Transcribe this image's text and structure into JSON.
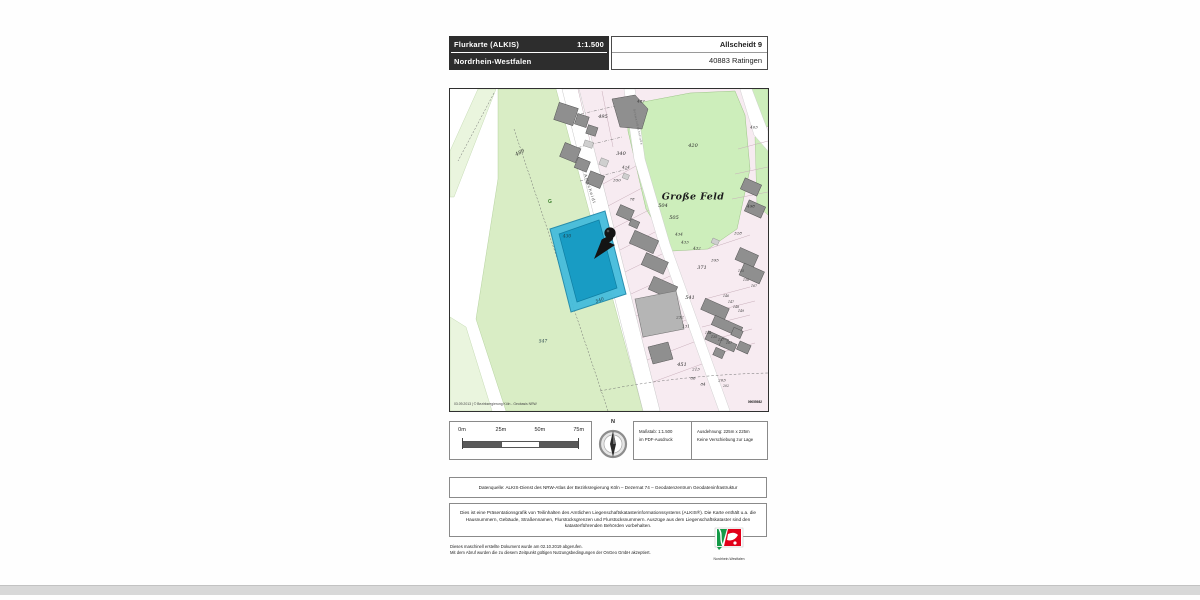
{
  "header": {
    "title": "Flurkarte (ALKIS)",
    "scale": "1:1.500",
    "state": "Nordrhein-Westfalen",
    "address_line1": "Allscheidt 9",
    "address_line2": "40883 Ratingen"
  },
  "map": {
    "copyright": "03.09.2013 | © Bezirksregierung Köln - Geobasis NRW",
    "sheet_number": "09055982",
    "highlight_color": "#35b7db",
    "area_labels": [
      {
        "text": "489",
        "x": 70,
        "y": 64,
        "rot": -28,
        "cls": "num"
      },
      {
        "text": "495",
        "x": 153,
        "y": 28,
        "cls": "num"
      },
      {
        "text": "487",
        "x": 191,
        "y": 12,
        "cls": "num-sm"
      },
      {
        "text": "403",
        "x": 304,
        "y": 38,
        "cls": "num-sm"
      },
      {
        "text": "420",
        "x": 243,
        "y": 57,
        "cls": "num"
      },
      {
        "text": "340",
        "x": 171,
        "y": 65,
        "cls": "num"
      },
      {
        "text": "424",
        "x": 176,
        "y": 78,
        "cls": "num-sm"
      },
      {
        "text": "350",
        "x": 167,
        "y": 91,
        "cls": "num-sm"
      },
      {
        "text": "Große Feld",
        "x": 243,
        "y": 108,
        "cls": "place"
      },
      {
        "text": "498",
        "x": 301,
        "y": 117,
        "cls": "num-sm"
      },
      {
        "text": "78",
        "x": 182,
        "y": 110,
        "cls": "num-sm"
      },
      {
        "text": "504",
        "x": 213,
        "y": 117,
        "cls": "num"
      },
      {
        "text": "505",
        "x": 224,
        "y": 129,
        "cls": "num"
      },
      {
        "text": "434",
        "x": 229,
        "y": 145,
        "cls": "num-sm"
      },
      {
        "text": "433",
        "x": 235,
        "y": 153,
        "cls": "num-sm"
      },
      {
        "text": "432",
        "x": 247,
        "y": 159,
        "cls": "num-sm"
      },
      {
        "text": "328",
        "x": 288,
        "y": 144,
        "cls": "num-sm"
      },
      {
        "text": "371",
        "x": 252,
        "y": 179,
        "cls": "num"
      },
      {
        "text": "395",
        "x": 265,
        "y": 171,
        "cls": "num-sm"
      },
      {
        "text": "155",
        "x": 291,
        "y": 182,
        "cls": "num-xs"
      },
      {
        "text": "156",
        "x": 296,
        "y": 191,
        "cls": "num-xs"
      },
      {
        "text": "167",
        "x": 304,
        "y": 197,
        "cls": "num-xs"
      },
      {
        "text": "146",
        "x": 276,
        "y": 207,
        "cls": "num-xs"
      },
      {
        "text": "147",
        "x": 281,
        "y": 213,
        "cls": "num-xs"
      },
      {
        "text": "148",
        "x": 286,
        "y": 218,
        "cls": "num-xs"
      },
      {
        "text": "149",
        "x": 291,
        "y": 222,
        "cls": "num-xs"
      },
      {
        "text": "232",
        "x": 230,
        "y": 228,
        "cls": "num-sm"
      },
      {
        "text": "131",
        "x": 236,
        "y": 237,
        "cls": "num-sm"
      },
      {
        "text": "134",
        "x": 258,
        "y": 244,
        "cls": "num-xs"
      },
      {
        "text": "135",
        "x": 264,
        "y": 248,
        "cls": "num-xs"
      },
      {
        "text": "137",
        "x": 271,
        "y": 251,
        "cls": "num-xs"
      },
      {
        "text": "107",
        "x": 279,
        "y": 254,
        "cls": "num-xs"
      },
      {
        "text": "213",
        "x": 246,
        "y": 280,
        "cls": "num-sm"
      },
      {
        "text": "86",
        "x": 243,
        "y": 289,
        "cls": "num-sm"
      },
      {
        "text": "84",
        "x": 253,
        "y": 295,
        "cls": "num-sm"
      },
      {
        "text": "203",
        "x": 272,
        "y": 291,
        "cls": "num-sm"
      },
      {
        "text": "202",
        "x": 276,
        "y": 297,
        "cls": "num-xs"
      },
      {
        "text": "541",
        "x": 240,
        "y": 209,
        "cls": "num"
      },
      {
        "text": "547",
        "x": 93,
        "y": 253,
        "cls": "num-it"
      },
      {
        "text": "451",
        "x": 232,
        "y": 276,
        "cls": "num"
      },
      {
        "text": "430",
        "x": 117,
        "y": 148,
        "cls": "num-it"
      },
      {
        "text": "540",
        "x": 150,
        "y": 212,
        "rot": -20,
        "cls": "num-it"
      },
      {
        "text": "Allscheidt",
        "x": 140,
        "y": 100,
        "rot": 72,
        "cls": "street"
      },
      {
        "text": "Schwarzbachstraße",
        "x": 188,
        "y": 38,
        "rot": 78,
        "cls": "street-sm"
      },
      {
        "text": "G",
        "x": 100,
        "y": 113,
        "cls": "sym-g"
      }
    ]
  },
  "legend": {
    "scale_ticks": [
      "0m",
      "25m",
      "50m",
      "75m"
    ],
    "north_label": "N",
    "info_scale_line1": "Maßstab: 1:1.500",
    "info_scale_line2": "im PDF-Ausdruck",
    "info_extent_line1": "Ausdehnung: 225m x 225m",
    "info_extent_line2": "Keine Verschiebung zur Lage"
  },
  "source_box": {
    "text": "Datenquelle: ALKIS-Dienst des NRW-Atlas der Bezirksregierung Köln – Dezernat 74 – Geodatenzentrum Geodateninfrastruktur"
  },
  "disclaimer_box": {
    "text": "Dies ist eine Präsentationsgrafik von Teilinhalten des Amtlichen Liegenschaftskatasterinformationssystems (ALKIS®). Die Karte enthält u.a. die Hausnummern, Gebäude, Straßennamen, Flurstücksgrenzen und Flurstücksnummern. Auszüge aus dem Liegenschaftskataster sind den katasterführenden Behörden vorbehalten."
  },
  "footer": {
    "note_line1": "Dieses maschinell erstellte Dokument wurde am 02.10.2019 abgerufen.",
    "note_line2": "Mit dem Abruf wurden die zu diesem Zeitpunkt gültigen Nutzungsbedingungen der OnGeo GmbH akzeptiert.",
    "logo_caption": "Nordrhein-Westfalen"
  }
}
